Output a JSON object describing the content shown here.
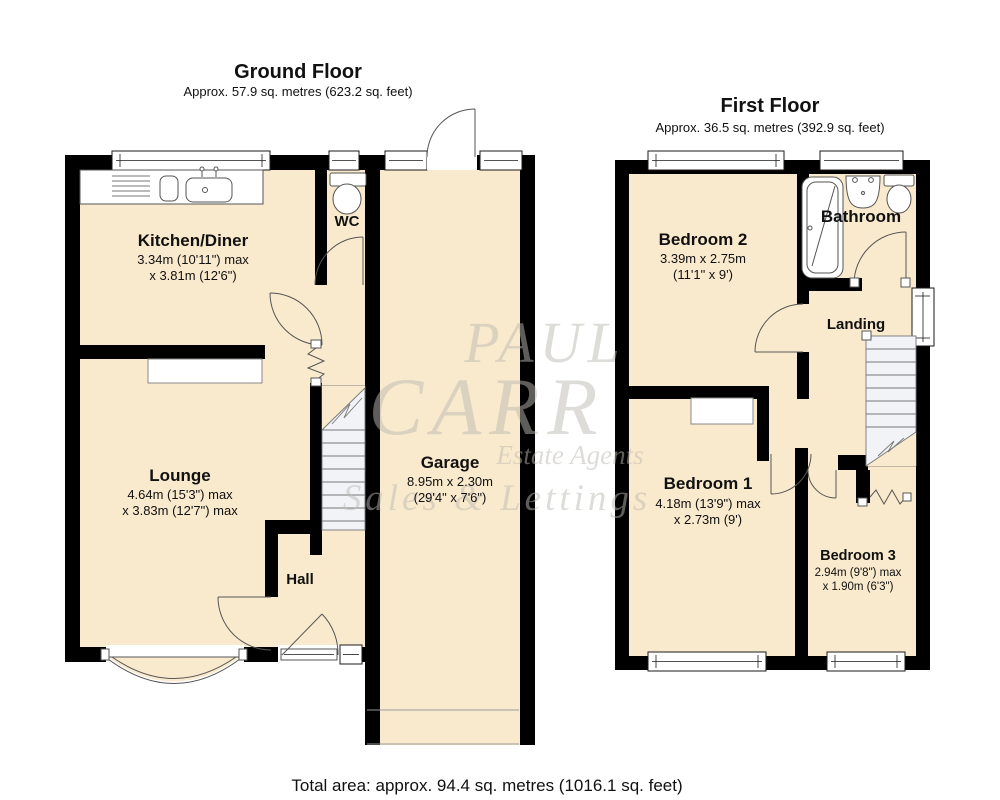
{
  "ground_floor": {
    "title": "Ground Floor",
    "subtitle": "Approx. 57.9 sq. metres (623.2 sq. feet)",
    "rooms": {
      "kitchen": {
        "name": "Kitchen/Diner",
        "dim1": "3.34m (10'11\") max",
        "dim2": "x 3.81m (12'6\")"
      },
      "wc": {
        "name": "WC"
      },
      "lounge": {
        "name": "Lounge",
        "dim1": "4.64m (15'3\") max",
        "dim2": "x 3.83m (12'7\") max"
      },
      "garage": {
        "name": "Garage",
        "dim1": "8.95m x 2.30m",
        "dim2": "(29'4\" x 7'6\")"
      },
      "hall": {
        "name": "Hall"
      }
    }
  },
  "first_floor": {
    "title": "First Floor",
    "subtitle": "Approx. 36.5 sq. metres (392.9 sq. feet)",
    "rooms": {
      "bedroom2": {
        "name": "Bedroom 2",
        "dim1": "3.39m x 2.75m",
        "dim2": "(11'1\" x 9')"
      },
      "bathroom": {
        "name": "Bathroom"
      },
      "landing": {
        "name": "Landing"
      },
      "bedroom1": {
        "name": "Bedroom 1",
        "dim1": "4.18m (13'9\") max",
        "dim2": "x 2.73m (9')"
      },
      "bedroom3": {
        "name": "Bedroom 3",
        "dim1": "2.94m (9'8\") max",
        "dim2": "x 1.90m (6'3\")"
      }
    }
  },
  "watermark": {
    "line1": "PAUL",
    "line2": "CARR",
    "line3": "Estate Agents",
    "line4": "Sales & Lettings"
  },
  "footer": {
    "total_area": "Total area: approx. 94.4 sq. metres (1016.1 sq. feet)"
  },
  "colors": {
    "room_fill": "#FAEACD",
    "wall": "#000000",
    "stair_fill": "#F1F3F7",
    "line": "#555555",
    "watermark": "#BDBAB3"
  }
}
